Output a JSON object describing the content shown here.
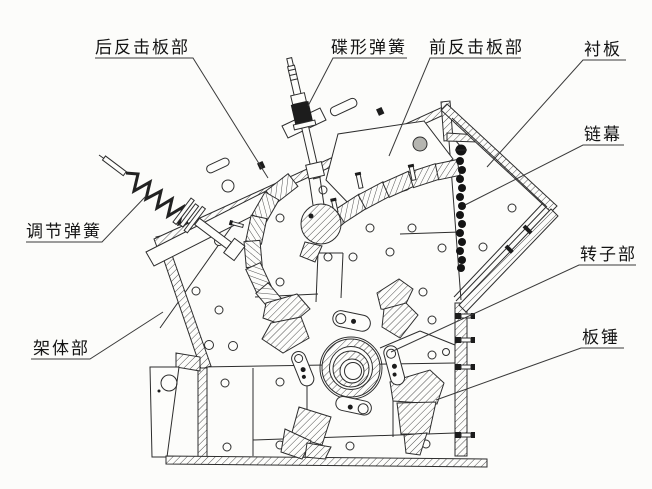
{
  "diagram": {
    "labels": [
      {
        "id": "rear-impact-plate-assembly",
        "text": "后反击板部"
      },
      {
        "id": "disc-spring",
        "text": "碟形弹簧"
      },
      {
        "id": "front-impact-plate-assembly",
        "text": "前反击板部"
      },
      {
        "id": "liner-plate",
        "text": "衬板"
      },
      {
        "id": "chain-curtain",
        "text": "链幕"
      },
      {
        "id": "adjusting-spring",
        "text": "调节弹簧"
      },
      {
        "id": "frame-assembly",
        "text": "架体部"
      },
      {
        "id": "rotor-assembly",
        "text": "转子部"
      },
      {
        "id": "blow-bar",
        "text": "板锤"
      }
    ],
    "colors": {
      "background": "#fcfcfa",
      "line": "#2d2d2d",
      "label_text": "#141414"
    }
  }
}
